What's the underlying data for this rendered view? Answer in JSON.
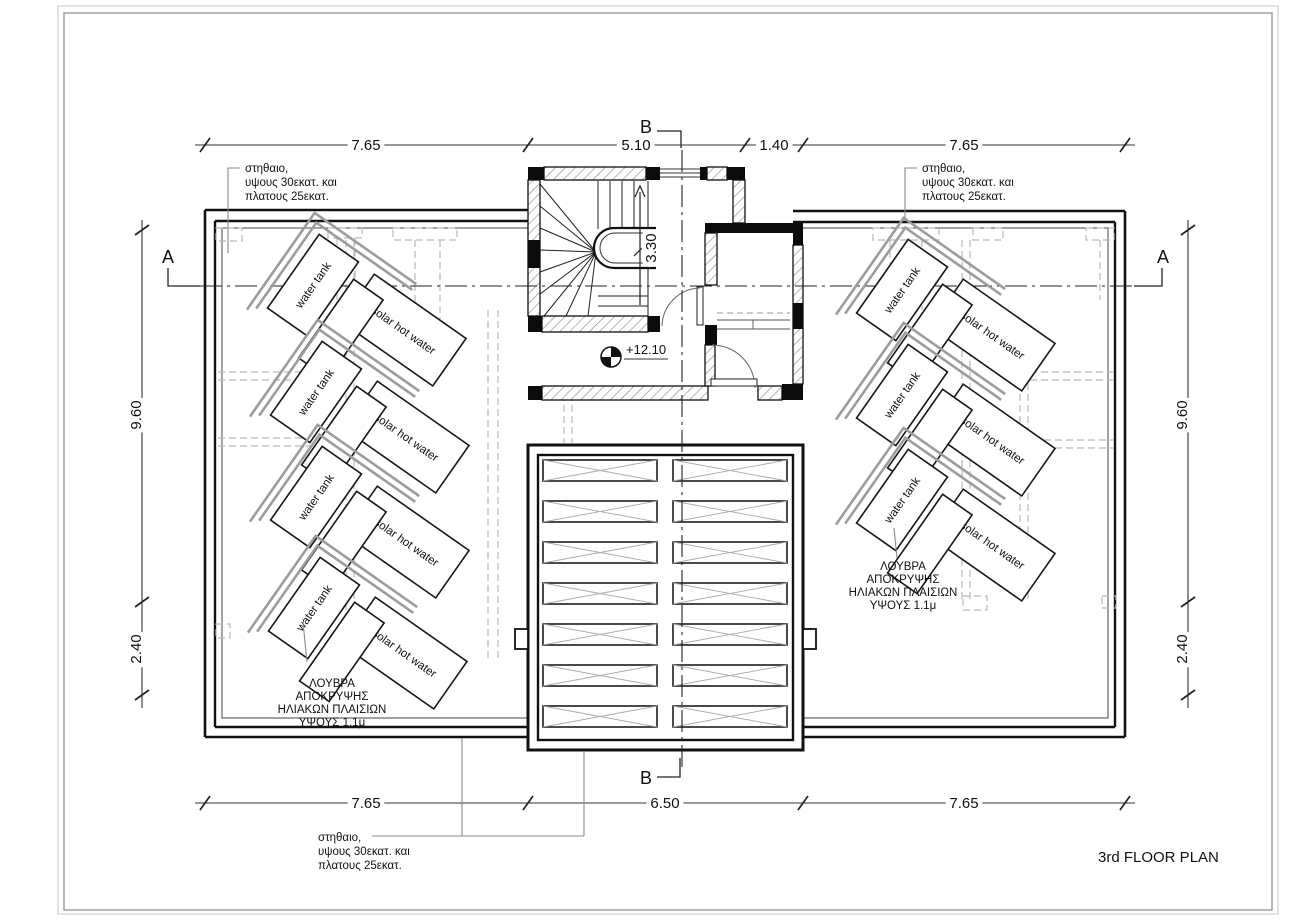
{
  "sheet": {
    "title": "3rd FLOOR PLAN"
  },
  "sections": {
    "a": "A",
    "b": "B"
  },
  "dimensions": {
    "top": [
      "7.65",
      "5.10",
      "1.40",
      "7.65"
    ],
    "bottom": [
      "7.65",
      "6.50",
      "7.65"
    ],
    "left": [
      "9.60",
      "2.40"
    ],
    "right": [
      "9.60",
      "2.40"
    ],
    "stair_height": "3.30"
  },
  "level": {
    "roof": "+12.10"
  },
  "equipment": {
    "water_tank": "water tank",
    "solar_hot_water": "solar hot water"
  },
  "notes": {
    "parapet": [
      "στηθαιο,",
      "υψους 30εκατ. και",
      "πλατους 25εκατ."
    ],
    "louvre": [
      "ΛΟΥΒΡΑ",
      "ΑΠΟΚΡΥΨΗΣ",
      "ΗΛΙΑΚΩΝ ΠΛΑΙΣΙΩΝ",
      "ΥΨΟΥΣ 1.1μ"
    ]
  }
}
